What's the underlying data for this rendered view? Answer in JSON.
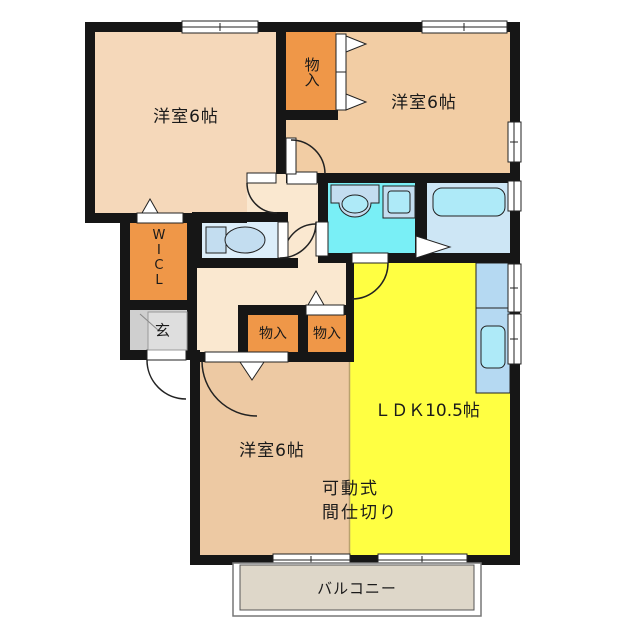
{
  "plan": {
    "type": "floorplan",
    "labels": {
      "bedroom_top_left": "洋室6帖",
      "bedroom_top_right": "洋室6帖",
      "bedroom_bottom": "洋室6帖",
      "ldk": "ＬＤＫ10.5帖",
      "closet_top": "物入",
      "closet_hall_left": "物入",
      "closet_hall_right": "物入",
      "walk_in_closet": "WICL",
      "entrance": "玄",
      "balcony": "バルコニー",
      "partition_line1": "可動式",
      "partition_line2": "間仕切り"
    },
    "colors": {
      "wall": "#161616",
      "hall": "#fae8d0",
      "bedroom_top_left": "#f5d8ba",
      "bedroom_top_right": "#f2cda4",
      "bedroom_bottom": "#edc9a3",
      "ldk": "#ffff42",
      "closet": "#ef9748",
      "entrance": "#cfcfcf",
      "entrance_inner": "#dedede",
      "toilet_room": "#dceefa",
      "washroom": "#79eff6",
      "bath": "#cde6f5",
      "kitchen_counter": "#b5d9f2",
      "fixture_blue": "#c3ddf0",
      "fixture_cyan": "#aeeaf8",
      "balcony": "#ded7c9",
      "outside": "#ffffff",
      "door_white": "#ffffff"
    }
  }
}
